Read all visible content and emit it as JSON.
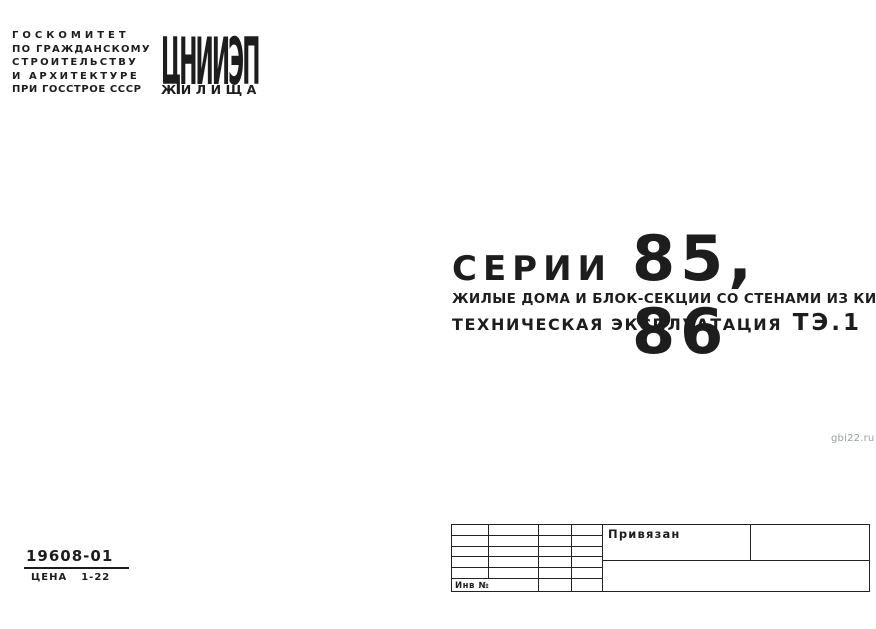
{
  "colors": {
    "paper": "#ffffff",
    "ink": "#1d1d1d",
    "watermark": "#9aa0a6"
  },
  "publisher": {
    "committee_lines": [
      "ГОСКОМИТЕТ",
      "ПО ГРАЖДАНСКОМУ",
      "СТРОИТЕЛЬСТВУ",
      "И АРХИТЕКТУРЕ",
      "ПРИ ГОССТРОЕ СССР"
    ],
    "logo_acronym": "ЦНИИЭП",
    "logo_subtitle": "ЖИЛИЩА"
  },
  "title": {
    "series_label": "СЕРИИ",
    "series_numbers": "85, 86",
    "subtitle": "ЖИЛЫЕ ДОМА И БЛОК-СЕКЦИИ СО СТЕНАМИ ИЗ КИРПИЧА",
    "doc_type": "ТЕХНИЧЕСКАЯ ЭКСПЛУАТАЦИЯ",
    "doc_code": "ТЭ.1"
  },
  "watermark": "gbi22.ru",
  "catalog": {
    "number": "19608-01",
    "price_label": "ЦЕНА",
    "price_value": "1-22"
  },
  "stamp": {
    "bound_label": "Привязан",
    "inventory_label": "Инв №"
  }
}
